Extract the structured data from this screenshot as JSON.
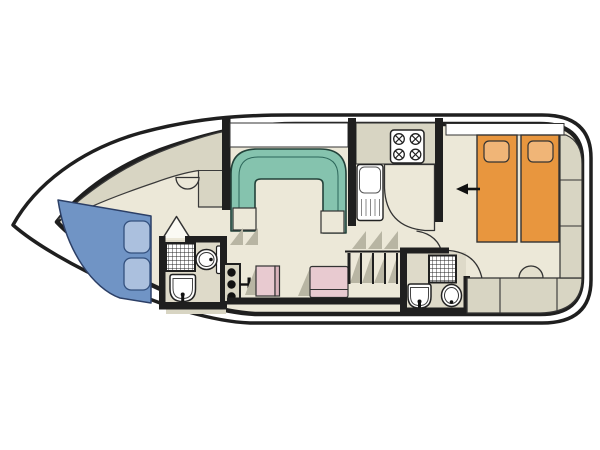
{
  "plan": {
    "vessel": "motor-cruiser-floorplan",
    "rooms": [
      "bow-deck",
      "forward-cabin",
      "forward-bathroom",
      "saloon",
      "helm",
      "galley",
      "aft-bathroom",
      "aft-cabin",
      "stern-storage"
    ],
    "furniture": [
      "double-berth",
      "pillows",
      "u-shaped-dinette",
      "helm-console",
      "helm-seat",
      "companion-seat",
      "galley-sink",
      "stove-4-burner",
      "worktop",
      "steps",
      "staircase",
      "shower",
      "toilet",
      "washbasin",
      "twin-berths",
      "stool",
      "bench-seating",
      "storage-lockers"
    ]
  },
  "colors": {
    "outline": "#1f1f1f",
    "hull_fill": "#ffffff",
    "floor": "#ece8d8",
    "deck_gray": "#d8d5c3",
    "shade_gray": "#b8b5a3",
    "bathroom_floor": "#dedac9",
    "dinette_teal": "#85c3ae",
    "bed_blue": "#7094c5",
    "pillow_blue": "#abc0de",
    "bed_orange": "#e8963e",
    "pillow_orange": "#f0b577",
    "seat_pink": "#e8cad0",
    "seat_pink_dark": "#d9b3bb",
    "fixture_white": "#ffffff",
    "window_white": "#ffffff",
    "stool_fill": "#e3dfcd",
    "arrow_black": "#111111"
  }
}
